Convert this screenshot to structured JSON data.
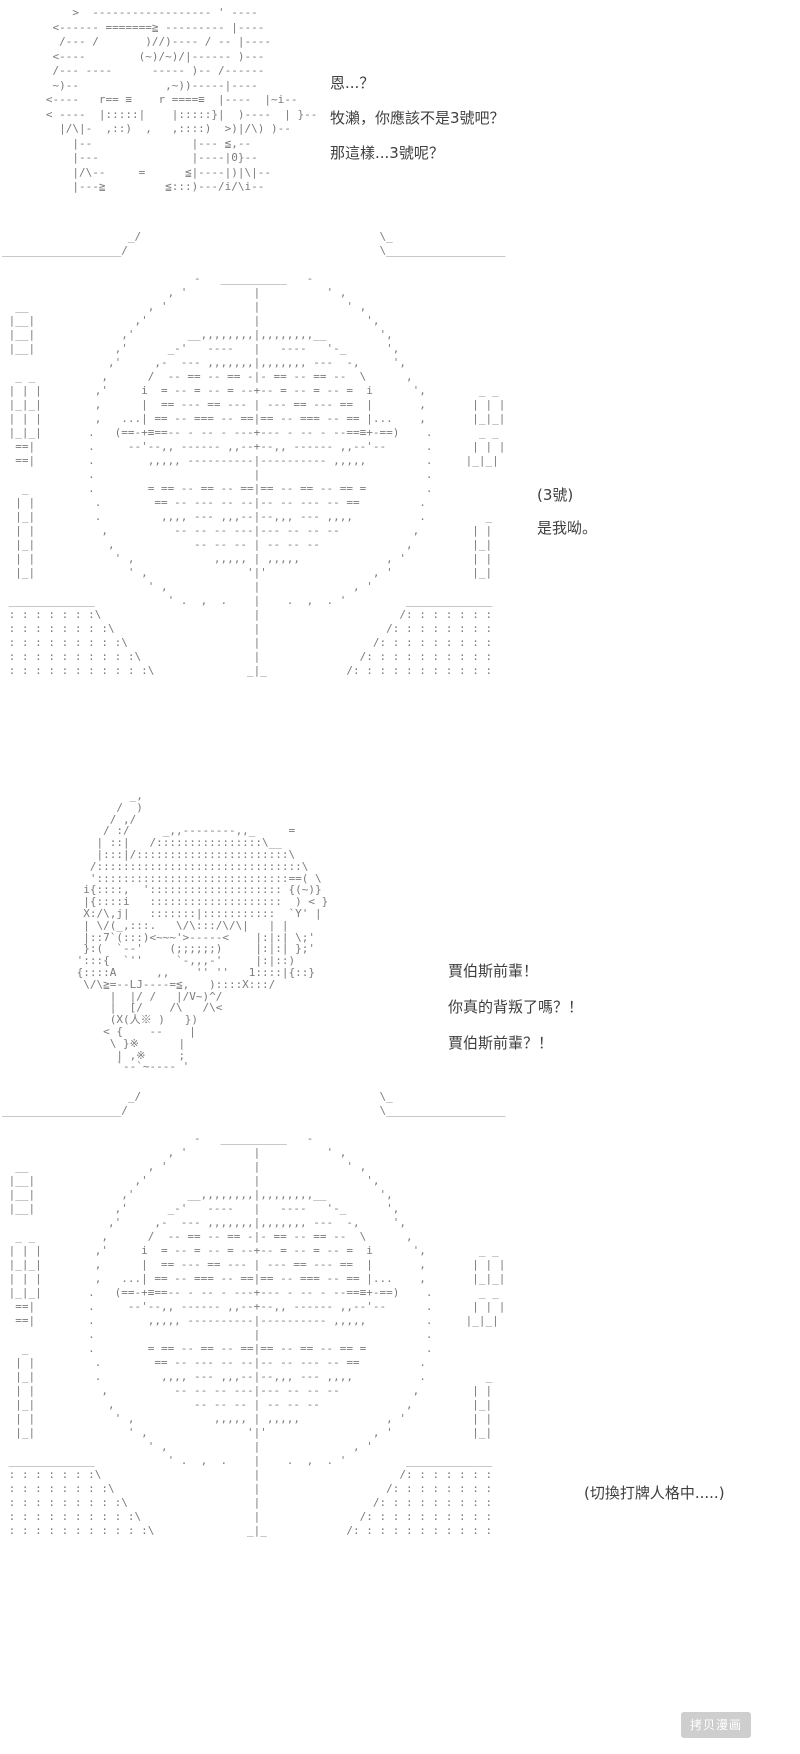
{
  "page": {
    "background": "#ffffff",
    "aa_color": "#7b7b7b",
    "dialogue_color": "#3f3f3f"
  },
  "panels": {
    "top_character": {
      "description": "ascii-art-figure-aiming",
      "lines": [
        "       >  ------------------ ' ----",
        "    <------ =======≧ --------- |----",
        "     /--- /       )//)---- / -- |----",
        "    <----        (~)/~)/|------ )---",
        "    /--- ----      ----- )-- /------",
        "    ~)--             ,~))-----|----",
        "   <----   r== ≡    r ====≡  |----  |~i--",
        "   < ----  |:::::|    |:::::}|  )----  | }--",
        "     |/\\|-  ,::)  ,   ,::::)  >)|/\\) )--",
        "       |--               |--- ≦,--",
        "       |---              |----|0}--",
        "       |/\\--     =      ≦|----|)|\\|--",
        "       |---≧         ≦:::)---/i/\\i--"
      ]
    },
    "mask_circle": {
      "description": "ascii-art-large-target-mask",
      "lines": [
        "                   _/                                    \\_",
        "__________________/                                      \\__________________",
        "",
        "                             -   __________   -",
        "                         , '          |          ' ,",
        "  __                  , '             |             ' ,",
        " |__|               ,'                |                ',",
        " |__|             ,'        __,,,,,,,,|,,,,,,,,__        ',",
        " |__|            ,'      _-'   ----   |   ----   '-_      ',",
        "                ,'     ,-  --- ,,,,,,,|,,,,,,, ---  -,     ',",
        "  _ _          ,      /  -- == -- == -|- == -- == --  \\      ,",
        " | | |        ,'     i  = -- = -- = --+-- = -- = -- =  i      ',        _ _",
        " |_|_|        ,      |  == --- == --- | --- == --- ==  |       ,       | | |",
        " | | |        ,   ...| == -- === -- ==|== -- === -- == |...    ,       |_|_|",
        " |_|_|       .   (==-+≡==-- - -- - ---+--- - -- - --==≡+-==)    .       _ _",
        "  ==|        .     --'--,, ------ ,,--+--,, ------ ,,--'--      .      | | |",
        "  ==|        .        ,,,,, ----------|---------- ,,,,,         .     |_|_|",
        "             .                        |                         .",
        "   _         .        = == -- == -- ==|== -- == -- == =         .",
        "  | |         .        == -- --- -- --|-- -- --- -- ==         .",
        "  |_|         .         ,,,, --- ,,,--|--,,, --- ,,,,          .         _",
        "  | |          ,          -- -- -- ---|--- -- -- --           ,        | |",
        "  |_|           ,            -- -- -- | -- -- --             ,         |_|",
        "  | |            ' ,            ,,,,, | ,,,,,             , '          | |",
        "  |_|              ' ,               '|'                , '            |_|",
        "                      ' ,             |              , '",
        " _____________           ' .  ,  .    |    .  ,  . '         _____________",
        " : : : : : : :\\                       |                     /: : : : : : :",
        " : : : : : : : :\\                     |                   /: : : : : : : :",
        " : : : : : : : : :\\                   |                 /: : : : : : : : :",
        " : : : : : : : : : :\\                 |               /: : : : : : : : : :",
        " : : : : : : : : : : :\\              _|_            /: : : : : : : : : : :"
      ]
    },
    "jobs_character": {
      "description": "ascii-art-spiky-hair-character",
      "lines": [
        "         _,",
        "       /  )",
        "      / ,/",
        "     / :/     _,,--------,,_     =",
        "    | ::|   /::::::::::::::::\\__",
        "    |:::|/:::::::::::::::::::::::\\",
        "   /:::::::::::::::::::::::::::::::\\",
        "   ':::::::::::::::::::::::::::::==( \\",
        "  i{::::,  ':::::::::::::::::::: {(~)}",
        "  |{::::i   ::::::::::::::::::::  ) < }",
        "  X:/\\,j|   :::::::|:::::::::::  `Y' |",
        "  | \\/(_,:::.   \\/\\:::/\\/\\|   | |",
        "  |::7`(:::)<~~~'>-----<    |:|:| \\;'",
        "  }:(  `--'    (;;;;;;)     |:|:| };'",
        " ':::{  `''     `-,,,-'     |:|::)",
        " {::::A      ,,    '' ''   1::::|{::}",
        "  \\/\\≧=--LJ----=≦,   )::::X:::/",
        "      |  |/ /   |/V~)^/",
        "      |  [/    /\\   /\\<",
        "      (X(人※ )   })",
        "     < {    --    |",
        "      \\ }※      |",
        "       | ,※     ;",
        "       `--`~---- '"
      ]
    }
  },
  "dialogues": {
    "block1": {
      "lines": [
        "恩...？",
        "牧瀨，你應該不是3號吧？",
        "那這樣...3號呢？"
      ]
    },
    "block2": {
      "lines": [
        "(3號)",
        "是我呦。"
      ]
    },
    "block3": {
      "lines": [
        "賈伯斯前輩！",
        "你真的背叛了嗎？！",
        "賈伯斯前輩？！"
      ]
    },
    "block4": {
      "lines": [
        "(切換打牌人格中.....)"
      ]
    }
  },
  "watermark": {
    "label": "拷贝漫画"
  }
}
